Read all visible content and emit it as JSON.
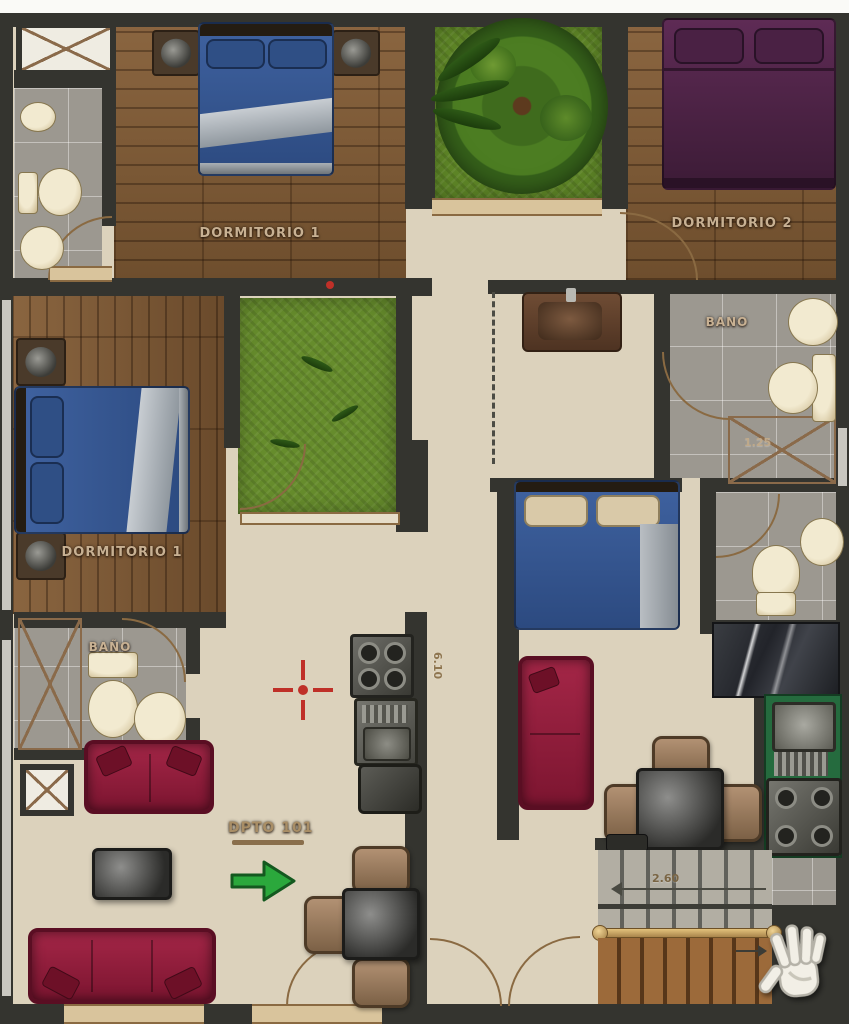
{
  "plan_type": "apartment-floor-plan",
  "rooms": {
    "bedroom_top_left": {
      "label": "DORMITORIO 1"
    },
    "bedroom_top_right": {
      "label": "DORMITORIO 2"
    },
    "bedroom_mid_left": {
      "label": "DORMITORIO 1"
    },
    "bathroom_top_right": {
      "label": "BANO"
    },
    "bathroom_bottom_left": {
      "label": "BAÑO"
    }
  },
  "unit": {
    "label": "DPTO 101"
  },
  "dimensions": {
    "shower_width": "1.25",
    "corridor_length": "6.10",
    "stair_width": "2.60"
  },
  "icons": {
    "hand_cursor": "open-hand-cursor",
    "direction_arrow": "green-right-arrow",
    "survey_marker": "red-crosshair"
  },
  "colors": {
    "wall": "#34342f",
    "floor_tile": "#dcd2bc",
    "wood": "#7c5a36",
    "grass": "#5d8426",
    "bath_tile": "#9c9890",
    "bed_blue": "#3c5d92",
    "bed_purple": "#552850",
    "sofa_red": "#8f1e3c",
    "counter_green": "#256b3e",
    "arrow_green": "#2ba83c",
    "marker_red": "#bf3028",
    "label_tan": "#c8b193"
  }
}
